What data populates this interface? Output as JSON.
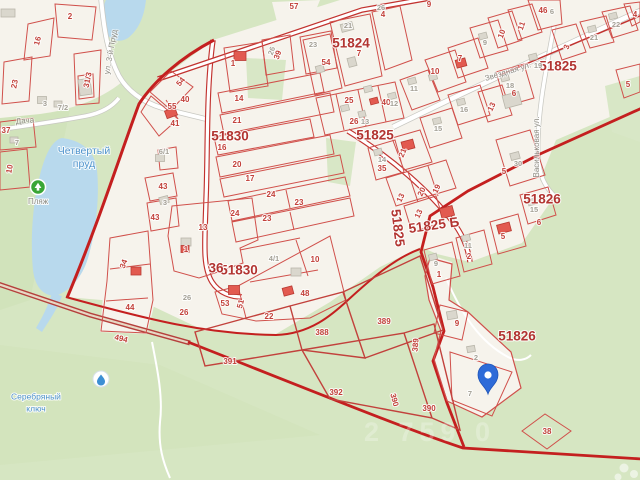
{
  "map": {
    "pin": {
      "x": 488,
      "y": 394
    },
    "watermark": {
      "t": "2 759 0",
      "x": 430,
      "y": 434
    },
    "quarter_labels": [
      [
        "51830",
        230,
        137
      ],
      [
        "51830",
        239,
        271
      ],
      [
        "36",
        216,
        269
      ],
      [
        "51824",
        351,
        44
      ],
      [
        "51825",
        558,
        67
      ],
      [
        "51825",
        375,
        136
      ],
      [
        "51825",
        397,
        228,
        83
      ],
      [
        "51825 Б",
        434,
        226,
        -8
      ],
      [
        "51826",
        542,
        200
      ],
      [
        "51826",
        517,
        337
      ]
    ],
    "parcel_labels": [
      [
        "2",
        70,
        17
      ],
      [
        "16",
        38,
        41,
        -75
      ],
      [
        "23",
        15,
        84,
        -80
      ],
      [
        "31/3",
        88,
        80,
        -78
      ],
      [
        "37",
        6,
        131
      ],
      [
        "10",
        10,
        169,
        -80
      ],
      [
        "54",
        181,
        82,
        -50
      ],
      [
        "55",
        172,
        107
      ],
      [
        "40",
        185,
        100
      ],
      [
        "41",
        175,
        124
      ],
      [
        "43",
        163,
        187
      ],
      [
        "43",
        155,
        218
      ],
      [
        "34",
        124,
        264,
        -70
      ],
      [
        "44",
        130,
        308
      ],
      [
        "494",
        121,
        339,
        14
      ],
      [
        "26",
        184,
        313
      ],
      [
        "13",
        203,
        228
      ],
      [
        "1",
        186,
        250
      ],
      [
        "1",
        233,
        64
      ],
      [
        "14",
        239,
        99
      ],
      [
        "21",
        237,
        121
      ],
      [
        "16",
        222,
        148
      ],
      [
        "20",
        237,
        165
      ],
      [
        "17",
        250,
        179
      ],
      [
        "24",
        271,
        195
      ],
      [
        "23",
        299,
        203
      ],
      [
        "24",
        235,
        214
      ],
      [
        "23",
        267,
        219
      ],
      [
        "39",
        278,
        55,
        -70
      ],
      [
        "54",
        326,
        63
      ],
      [
        "10",
        315,
        260
      ],
      [
        "48",
        305,
        294
      ],
      [
        "53",
        225,
        304
      ],
      [
        "51",
        241,
        304,
        -75
      ],
      [
        "22",
        269,
        317
      ],
      [
        "57",
        294,
        7
      ],
      [
        "4",
        383,
        15
      ],
      [
        "9",
        429,
        5
      ],
      [
        "7",
        359,
        54
      ],
      [
        "25",
        349,
        101
      ],
      [
        "26",
        354,
        122
      ],
      [
        "40",
        386,
        103
      ],
      [
        "10",
        435,
        72
      ],
      [
        "46",
        543,
        11
      ],
      [
        "4",
        635,
        15
      ],
      [
        "7",
        460,
        59
      ],
      [
        "11",
        522,
        26,
        -70
      ],
      [
        "10",
        502,
        34,
        -70
      ],
      [
        "3",
        567,
        47,
        -70
      ],
      [
        "6",
        514,
        94
      ],
      [
        "13",
        492,
        107,
        -65
      ],
      [
        "5",
        628,
        85
      ],
      [
        "5",
        504,
        172
      ],
      [
        "6",
        539,
        223
      ],
      [
        "21",
        403,
        153,
        -68
      ],
      [
        "35",
        382,
        169
      ],
      [
        "13",
        401,
        198,
        -65
      ],
      [
        "20",
        422,
        192,
        -65
      ],
      [
        "19",
        437,
        189,
        -65
      ],
      [
        "13",
        419,
        214,
        -65
      ],
      [
        "5",
        503,
        237
      ],
      [
        "2",
        469,
        257
      ],
      [
        "1",
        439,
        275
      ],
      [
        "9",
        457,
        324
      ],
      [
        "38",
        547,
        432
      ],
      [
        "388",
        322,
        333
      ],
      [
        "389",
        384,
        322
      ],
      [
        "389",
        416,
        345,
        -85
      ],
      [
        "391",
        230,
        362
      ],
      [
        "392",
        336,
        393
      ],
      [
        "390",
        394,
        400,
        75
      ],
      [
        "390",
        429,
        409
      ]
    ],
    "building_labels": [
      [
        "3",
        45,
        104
      ],
      [
        "7/2",
        63,
        108
      ],
      [
        "7",
        17,
        143
      ],
      [
        "6/1",
        164,
        152
      ],
      [
        "3",
        165,
        203
      ],
      [
        "26",
        187,
        298
      ],
      [
        "26",
        272,
        51,
        -70
      ],
      [
        "23",
        313,
        45
      ],
      [
        "21",
        348,
        26
      ],
      [
        "26",
        381,
        8
      ],
      [
        "13",
        365,
        122
      ],
      [
        "12",
        394,
        104
      ],
      [
        "11",
        414,
        89
      ],
      [
        "16",
        464,
        110
      ],
      [
        "15",
        438,
        129
      ],
      [
        "9",
        485,
        43
      ],
      [
        "19",
        538,
        66
      ],
      [
        "18",
        510,
        86
      ],
      [
        "21",
        594,
        38
      ],
      [
        "22",
        616,
        25
      ],
      [
        "6",
        552,
        12
      ],
      [
        "30",
        518,
        164
      ],
      [
        "15",
        534,
        210
      ],
      [
        "14",
        382,
        160
      ],
      [
        "11",
        468,
        246
      ],
      [
        "9",
        436,
        264
      ],
      [
        "2",
        476,
        358
      ],
      [
        "7",
        470,
        394
      ],
      [
        "4/1",
        274,
        259
      ]
    ],
    "street_labels": [
      [
        "ул. 3-й Пруд",
        111,
        52,
        -80
      ],
      [
        "Дача",
        25,
        121,
        -4
      ],
      [
        "Звёздная ул.",
        508,
        72,
        -17
      ],
      [
        "Васильковая ул.",
        537,
        147,
        -90
      ]
    ],
    "water_labels": [
      [
        "Четвертый",
        84,
        151
      ],
      [
        "пруд",
        84,
        164
      ]
    ],
    "water_small_labels": [
      [
        "Серебряный",
        36,
        397
      ],
      [
        "ключ",
        36,
        409
      ]
    ],
    "poi_labels": [
      [
        "Пляж",
        38,
        202
      ]
    ],
    "buildings": [
      [
        8,
        13,
        14,
        8,
        0,
        "g"
      ],
      [
        85,
        87,
        12,
        16,
        -8,
        "g"
      ],
      [
        42,
        100,
        9,
        7,
        0,
        "g"
      ],
      [
        58,
        104,
        8,
        6,
        0,
        "g"
      ],
      [
        14,
        140,
        8,
        6,
        0,
        "g"
      ],
      [
        160,
        158,
        9,
        7,
        0,
        "g"
      ],
      [
        164,
        200,
        9,
        7,
        -15,
        "g"
      ],
      [
        186,
        242,
        10,
        8,
        0,
        "g"
      ],
      [
        296,
        272,
        10,
        8,
        0,
        "g"
      ],
      [
        347,
        27,
        12,
        8,
        -15,
        "g"
      ],
      [
        352,
        62,
        8,
        9,
        -15,
        "g"
      ],
      [
        320,
        69,
        8,
        7,
        -15,
        "g"
      ],
      [
        368,
        89,
        8,
        6,
        -15,
        "g"
      ],
      [
        345,
        108,
        8,
        6,
        -15,
        "g"
      ],
      [
        362,
        114,
        7,
        6,
        -15,
        "g"
      ],
      [
        392,
        96,
        8,
        6,
        -15,
        "g"
      ],
      [
        412,
        81,
        8,
        6,
        -15,
        "g"
      ],
      [
        433,
        77,
        8,
        6,
        -15,
        "g"
      ],
      [
        437,
        121,
        8,
        6,
        -15,
        "g"
      ],
      [
        461,
        102,
        8,
        6,
        -15,
        "g"
      ],
      [
        483,
        36,
        8,
        6,
        -15,
        "g"
      ],
      [
        505,
        78,
        8,
        6,
        -15,
        "g"
      ],
      [
        512,
        100,
        17,
        13,
        -15,
        "g"
      ],
      [
        533,
        57,
        8,
        6,
        -15,
        "g"
      ],
      [
        592,
        29,
        8,
        6,
        -15,
        "g"
      ],
      [
        613,
        16,
        8,
        6,
        -15,
        "g"
      ],
      [
        515,
        156,
        9,
        7,
        -15,
        "g"
      ],
      [
        532,
        202,
        8,
        6,
        -15,
        "g"
      ],
      [
        378,
        152,
        8,
        6,
        -15,
        "g"
      ],
      [
        466,
        238,
        8,
        6,
        -15,
        "g"
      ],
      [
        433,
        257,
        8,
        6,
        -15,
        "g"
      ],
      [
        452,
        315,
        10,
        8,
        -10,
        "g"
      ],
      [
        471,
        349,
        8,
        6,
        -10,
        "g"
      ],
      [
        240,
        56,
        12,
        9,
        0,
        "r"
      ],
      [
        171,
        113,
        11,
        8,
        -20,
        "r"
      ],
      [
        136,
        271,
        10,
        8,
        0,
        "r"
      ],
      [
        234,
        290,
        11,
        9,
        0,
        "r"
      ],
      [
        288,
        291,
        10,
        8,
        -15,
        "r"
      ],
      [
        408,
        145,
        12,
        9,
        -15,
        "r"
      ],
      [
        447,
        212,
        13,
        10,
        -15,
        "r"
      ],
      [
        504,
        228,
        13,
        9,
        -15,
        "r"
      ],
      [
        461,
        63,
        10,
        8,
        -15,
        "r"
      ],
      [
        374,
        101,
        8,
        6,
        -15,
        "r"
      ],
      [
        185,
        249,
        8,
        7,
        0,
        "r"
      ]
    ],
    "colors": {
      "vegetation": "#d6e6c2",
      "built_area": "#f6f3ec",
      "water": "#b8d9ed",
      "boundary_red": "#c41f1f",
      "parcel_red": "#d0504b",
      "pin_blue": "#2e6bd8",
      "beach_green": "#3aa636"
    }
  }
}
